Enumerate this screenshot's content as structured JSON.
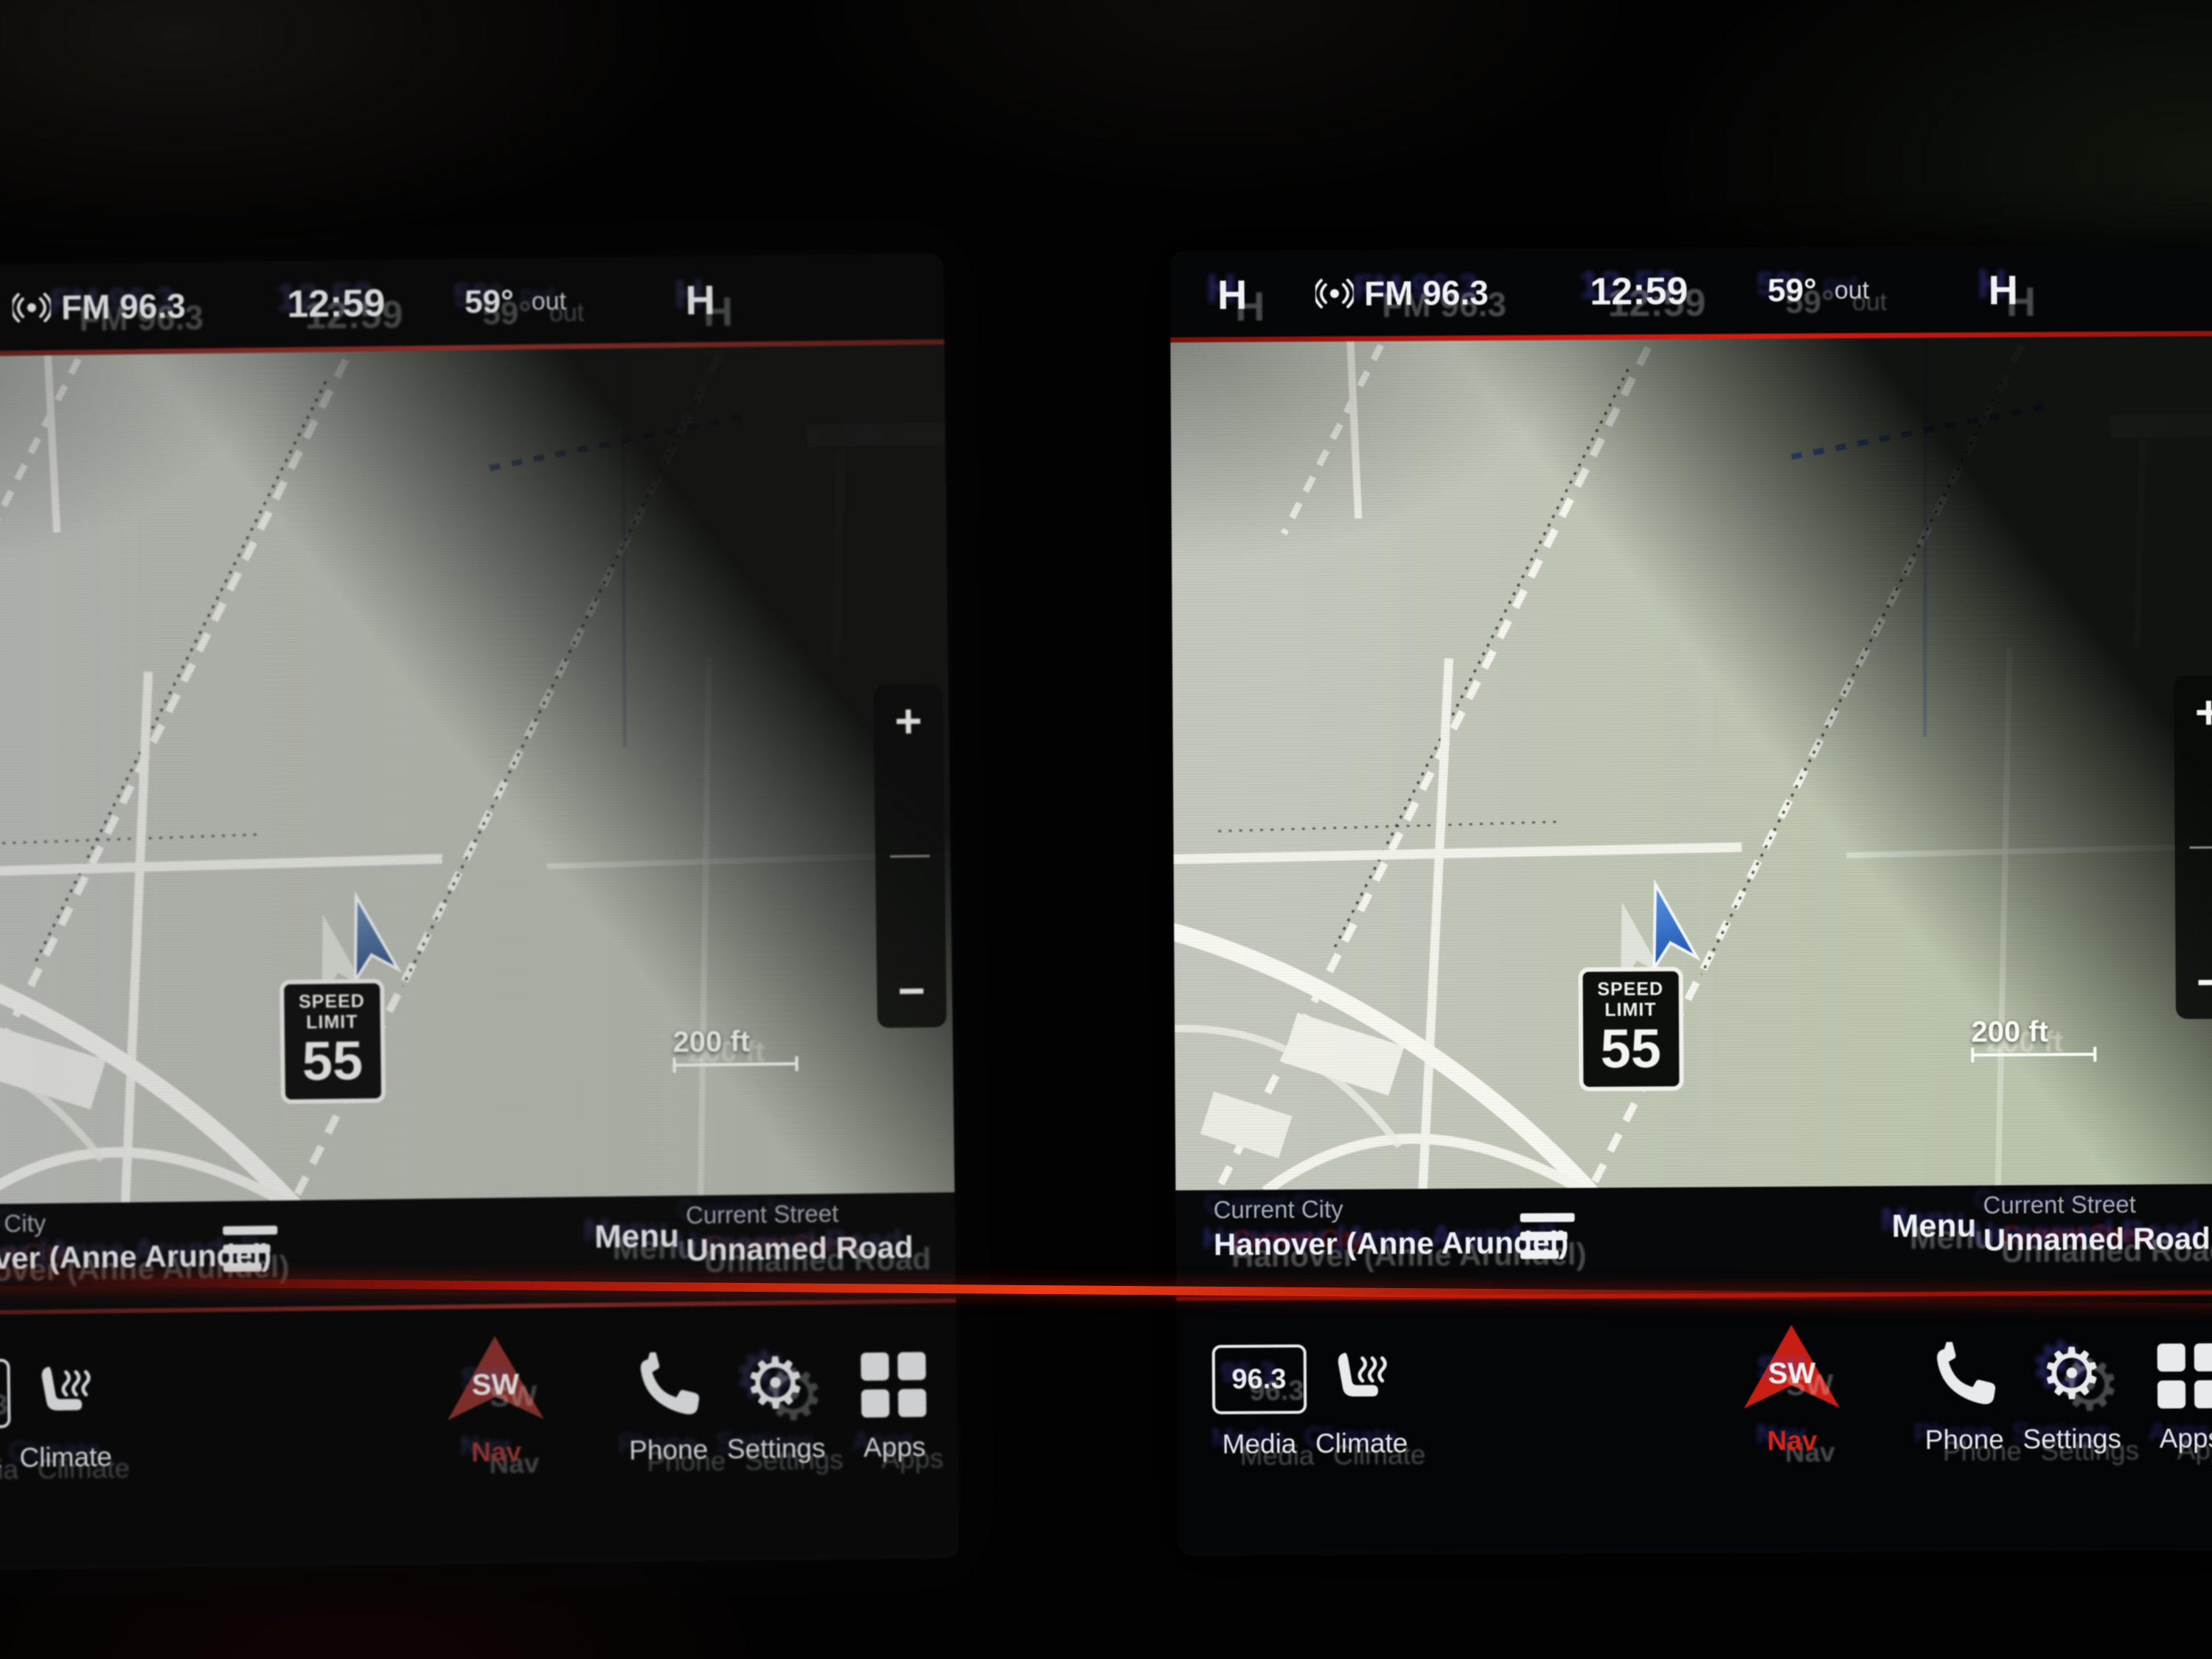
{
  "screen": {
    "status_bar": {
      "left_badge": "H",
      "right_badge": "H",
      "station": "FM 96.3",
      "time": "12:59",
      "outside_temp": "59°",
      "outside_temp_suffix": "out"
    },
    "map": {
      "scale_label": "200 ft",
      "speed_limit_title": "SPEED LIMIT",
      "speed_limit_value": "55",
      "zoom_in_label": "+",
      "zoom_out_label": "−"
    },
    "info_bar": {
      "city_label": "Current City",
      "city_value": "Hanover (Anne Arundel)",
      "menu_label": "Menu",
      "street_label": "Current Street",
      "street_value": "Unnamed Road"
    },
    "menu_bar": {
      "items": [
        {
          "id": "media",
          "label": "Media",
          "icon": "radio-station-icon",
          "icon_text": "96.3",
          "active": false
        },
        {
          "id": "climate",
          "label": "Climate",
          "icon": "heated-seat-icon",
          "icon_text": "",
          "active": false
        },
        {
          "id": "nav",
          "label": "Nav",
          "icon": "nav-compass-arrow-icon",
          "icon_text": "SW",
          "active": true
        },
        {
          "id": "phone",
          "label": "Phone",
          "icon": "phone-icon",
          "icon_text": "",
          "active": false
        },
        {
          "id": "settings",
          "label": "Settings",
          "icon": "gear-icon",
          "icon_text": "",
          "active": false
        },
        {
          "id": "apps",
          "label": "Apps",
          "icon": "apps-grid-icon",
          "icon_text": "",
          "active": false
        }
      ]
    }
  },
  "colors": {
    "accent_red": "#c1170f",
    "route_blue": "#3d6fe0",
    "map_day_green": "#bdc7ae",
    "map_gray": "#c6c9c1",
    "screen_black": "#06070a"
  }
}
